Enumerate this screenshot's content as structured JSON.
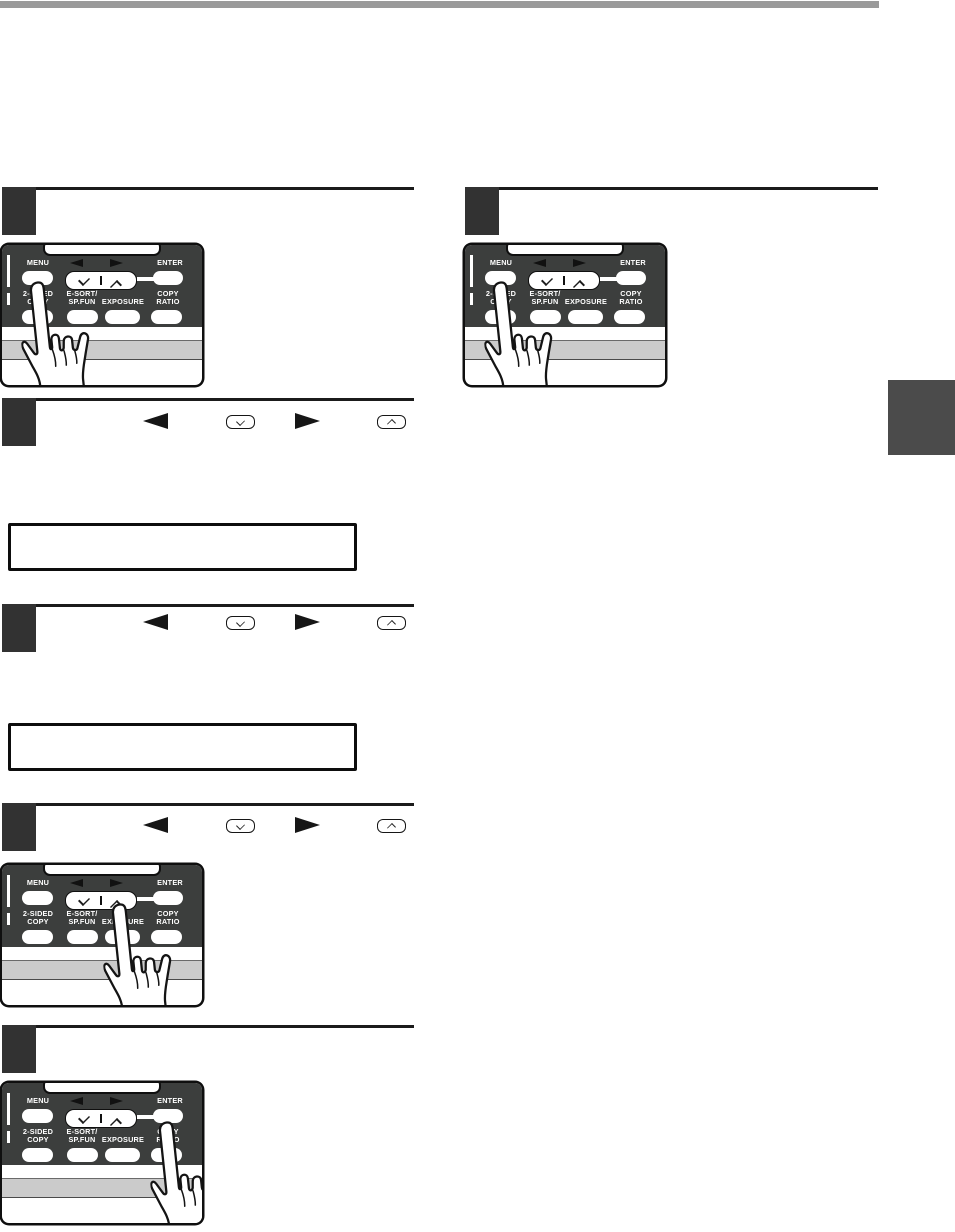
{
  "page": {
    "background": "#ffffff",
    "top_bar_color": "#9a9a9a",
    "side_tab_color": "#4b4b4b",
    "rule_color": "#1b1b1b",
    "step_marker_color": "#323232"
  },
  "control_panel": {
    "body_color": "#3c3e3d",
    "stripe_color": "#cbcbcb",
    "button_labels": {
      "menu": "MENU",
      "enter": "ENTER",
      "two_sided_copy_line1": "2-SIDED",
      "two_sided_copy_line2": "COPY",
      "e_sort_line1": "E-SORT/",
      "e_sort_line2": "SP.FUN",
      "exposure": "EXPOSURE",
      "copy_ratio_line1": "COPY",
      "copy_ratio_line2": "RATIO"
    },
    "icons": [
      "left-arrow",
      "right-arrow",
      "down-chevron",
      "up-chevron",
      "rocker-divider",
      "pointing-hand"
    ]
  },
  "steps": {
    "left": [
      {
        "marker_text": "",
        "illustration": "control-panel-press-menu"
      },
      {
        "marker_text": "",
        "inline_icons": [
          "left-arrow-key",
          "down-key",
          "right-arrow-key",
          "up-key"
        ],
        "lcd_text": ""
      },
      {
        "marker_text": "",
        "inline_icons": [
          "left-arrow-key",
          "down-key",
          "right-arrow-key",
          "up-key"
        ],
        "lcd_text": ""
      },
      {
        "marker_text": "",
        "inline_icons": [
          "left-arrow-key",
          "down-key",
          "right-arrow-key",
          "up-key"
        ],
        "illustration": "control-panel-press-right-arrow"
      },
      {
        "marker_text": "",
        "illustration": "control-panel-press-enter"
      }
    ],
    "right": [
      {
        "marker_text": "",
        "illustration": "control-panel-press-menu"
      }
    ]
  }
}
